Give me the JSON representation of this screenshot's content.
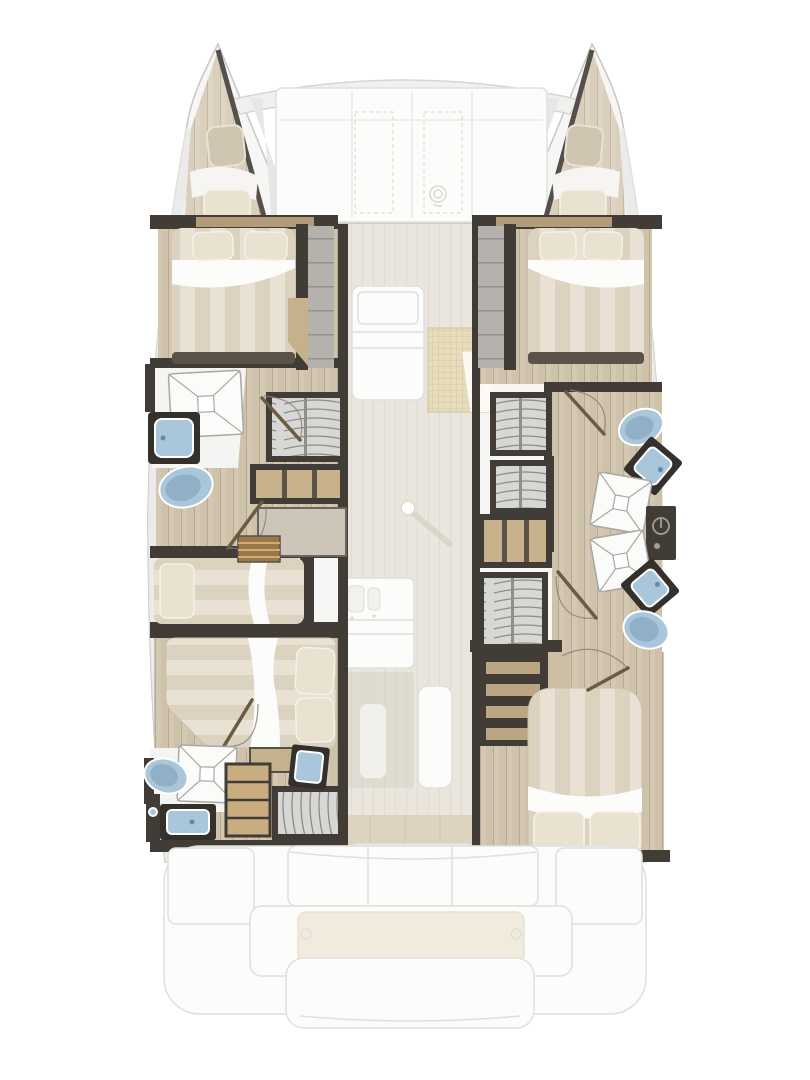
{
  "document": {
    "type": "yacht deck plan",
    "view": "top-down interior layout",
    "vessel": "sailing catamaran",
    "aria_label": "Catamaran floor plan: four double cabins, one single berth, four bathrooms, central saloon with galley, foredeck lounge and aft cockpit with swim platform"
  },
  "inventory": {
    "hulls": 2,
    "double_cabins": 4,
    "single_berths": 1,
    "bathrooms": 4,
    "showers": 4,
    "toilets": 4,
    "washbasins": 5,
    "wardrobes": 5,
    "forepeak_hatches": 2
  },
  "areas": {
    "bow": [
      "port forepeak hatch",
      "port bow cushion",
      "crossbeam",
      "foredeck lounge panels",
      "starboard forepeak hatch",
      "starboard bow cushion"
    ],
    "port_hull": [
      "forward double cabin",
      "companionway stairs",
      "forward bathroom: shower, washbasin, toilet",
      "wardrobe",
      "shelf unit",
      "single berth",
      "entry steps",
      "aft double cabin (athwartships)",
      "aft bathroom: shower, washbasin, toilet",
      "drawer unit",
      "aft wardrobe"
    ],
    "starboard_hull": [
      "forward double cabin",
      "companionway stairs",
      "two wardrobes",
      "forward bathroom: toilet, washbasin, shower",
      "technical locker",
      "aft bathroom: shower, washbasin, toilet",
      "corridor shelf and wardrobe",
      "stairs",
      "aft double cabin"
    ],
    "saloon": [
      "settee",
      "woven mat",
      "table post",
      "galley sink unit",
      "galley counter",
      "island unit",
      "aft sliding door"
    ],
    "stern": [
      "port cockpit locker",
      "cockpit bench (3 sections)",
      "starboard cockpit locker",
      "swim platform",
      "teak pad",
      "lower aft step"
    ]
  },
  "colors": {
    "hull_fill": "#f6f6f4",
    "hull_stroke": "#c6c6c4",
    "deck_gray": "#e7e7e5",
    "ghost_stroke": "#dfdfdd",
    "ghost_fill": "#fcfcfb",
    "teak": "#f1ebdd",
    "salon_floor": "#eae6dd",
    "wood_floor": "#cfc2ab",
    "wood_floor_light": "#d9cfbc",
    "bulkhead": "#413c36",
    "bulkhead_soft": "#5b5248",
    "trim_wood": "#b29b79",
    "shelf_wood": "#c7b28c",
    "drawer_wood": "#c9ad80",
    "bed_stripe": "#e9e2d4",
    "bed_stripe_alt": "#dcd2c0",
    "pillow": "#eae2d0",
    "linen": "#fcfcfb",
    "fixture_blue": "#a9c6da",
    "fixture_blue_deep": "#6488a5",
    "fixture_frame": "#34312d",
    "wardrobe_gray": "#d7d7d5",
    "hanger_line": "#8b8b87",
    "mat": "#e7dcbc",
    "mat_line": "#d7c8a3",
    "door_wood": "#6b5b45",
    "arc_line": "#8c8176"
  }
}
